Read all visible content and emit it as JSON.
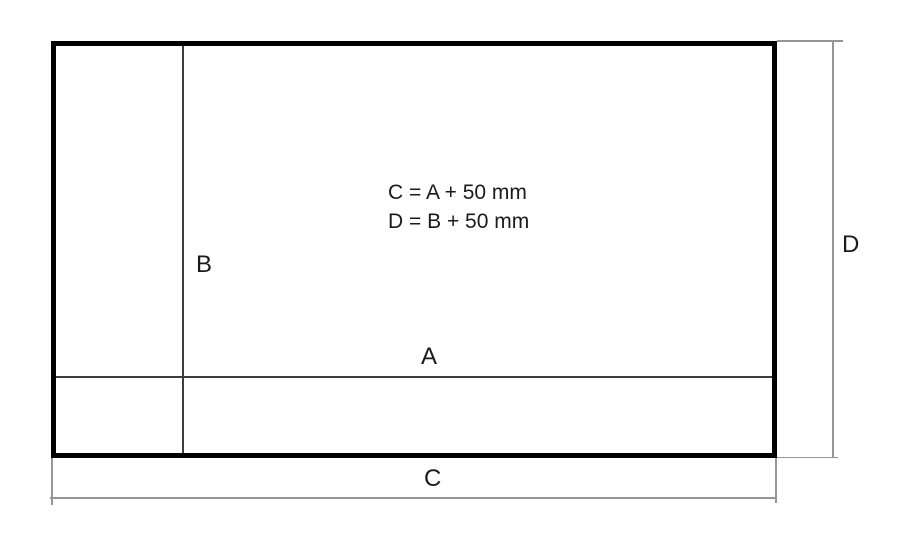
{
  "diagram": {
    "type": "dimension-drawing",
    "labels": {
      "inner_width": "A",
      "inner_height": "B",
      "outer_width": "C",
      "outer_height": "D"
    },
    "formula_lines": [
      "C = A + 50 mm",
      "D = B + 50 mm"
    ],
    "colors": {
      "outline": "#000000",
      "inner_line": "#3d3d3d",
      "dim_line": "#969696",
      "text_color": "#1a1a1a",
      "background": "#ffffff"
    }
  }
}
